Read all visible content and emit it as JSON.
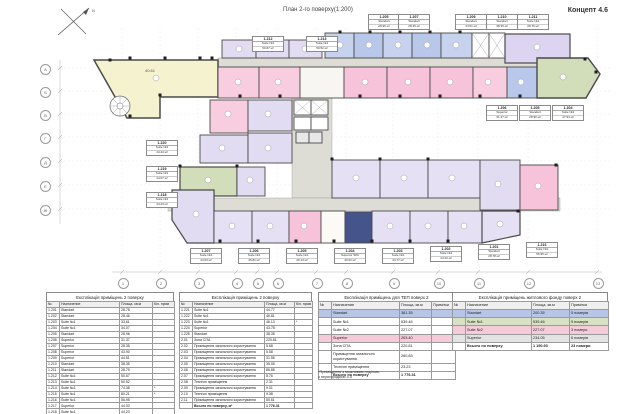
{
  "header": {
    "title": "План 2-го поверху(1:200)",
    "concept": "Концепт 4.6",
    "north_label": "N"
  },
  "plan": {
    "hall_area_label": "40.61",
    "grid_bottom": [
      "1",
      "2",
      "3",
      "4",
      "5",
      "6",
      "7",
      "8",
      "9",
      "10",
      "11",
      "12",
      "13"
    ],
    "grid_left": [
      "А",
      "Б",
      "В",
      "Г",
      "Д",
      "Е",
      "Ж"
    ],
    "callouts": {
      "top": [
        {
          "num": "1.212",
          "type": "Suite №1",
          "area": "50.67 м²"
        },
        {
          "num": "1.213",
          "type": "Suite №1",
          "area": "50.52 м²"
        },
        {
          "num": "1.205",
          "type": "Standart",
          "area": "28.96 м²"
        },
        {
          "num": "1.207",
          "type": "Standart",
          "area": "28.35 м²"
        },
        {
          "num": "1.209",
          "type": "Standart",
          "area": "44.51 м²"
        },
        {
          "num": "1.210",
          "type": "Standart",
          "area": "38.35 м²"
        },
        {
          "num": "1.211",
          "type": "Suite №1",
          "area": "28.79 м²"
        }
      ],
      "right": [
        {
          "num": "1.206",
          "type": "Superior",
          "area": "31.37 м²"
        },
        {
          "num": "1.205",
          "type": "Standart",
          "area": "28.96 м²"
        },
        {
          "num": "1.204",
          "type": "Suite №2",
          "area": "47.94 м²"
        }
      ],
      "left": [
        {
          "num": "1.220",
          "type": "Suite №1",
          "area": "44.44 м²"
        },
        {
          "num": "1.219",
          "type": "Suite №1",
          "area": "44.07 м²"
        },
        {
          "num": "1.218",
          "type": "Suite №1",
          "area": "44.23 м²"
        }
      ],
      "bottom": [
        {
          "num": "1.207",
          "type": "Suite №1",
          "area": "44.03 м²"
        },
        {
          "num": "1.206",
          "type": "Suite №1",
          "area": "46.81 м²"
        },
        {
          "num": "1.205",
          "type": "Suite №1",
          "area": "46.13 м²"
        },
        {
          "num": "1.204",
          "type": "Superior SPA",
          "area": "40.02 м²"
        },
        {
          "num": "1.203",
          "type": "Suite №1",
          "area": "44.77 м²"
        },
        {
          "num": "1.202",
          "type": "Suite №1",
          "area": "44.23 м²"
        },
        {
          "num": "1.201",
          "type": "Standart",
          "area": "28.78 м²"
        },
        {
          "num": "1.216",
          "type": "Suite №1",
          "area": "56.95 м²"
        }
      ]
    }
  },
  "tables": [
    {
      "title": "Експлікація приміщень 2 поверху",
      "columns": [
        "№",
        "Назначение",
        "Площа, кв.м",
        "Кіл. прим"
      ],
      "rows": [
        [
          "1.201",
          "Standart",
          "28.78",
          ""
        ],
        [
          "1.202",
          "Standart",
          "28.46",
          ""
        ],
        [
          "1.203",
          "Suite №1",
          "33.61",
          ""
        ],
        [
          "1.204",
          "Suite №1",
          "34.07",
          ""
        ],
        [
          "1.205",
          "Standart",
          "28.96",
          ""
        ],
        [
          "1.206",
          "Superior",
          "31.37",
          ""
        ],
        [
          "1.207",
          "Superior",
          "28.35",
          ""
        ],
        [
          "1.208",
          "Superior",
          "43.90",
          ""
        ],
        [
          "1.209",
          "Superior",
          "44.51",
          ""
        ],
        [
          "1.210",
          "Standart",
          "38.35",
          ""
        ],
        [
          "1.211",
          "Standart",
          "28.79",
          ""
        ],
        [
          "1.212",
          "Suite №1",
          "50.67",
          ""
        ],
        [
          "1.213",
          "Suite №1",
          "50.52",
          ""
        ],
        [
          "1.214",
          "Suite №1",
          "74.38",
          "*"
        ],
        [
          "1.215",
          "Suite №1",
          "80.21",
          "*"
        ],
        [
          "1.216",
          "Suite №1",
          "56.95",
          ""
        ],
        [
          "1.217",
          "Superior",
          "44.03",
          ""
        ],
        [
          "1.218",
          "Suite №1",
          "44.23",
          ""
        ],
        [
          "1.219",
          "Suite №1",
          "44.07",
          ""
        ],
        [
          "1.220",
          "Suite №1",
          "44.44",
          ""
        ]
      ]
    },
    {
      "title": "Експлікація приміщень 2 поверху",
      "columns": [
        "№",
        "Назначение",
        "Площа, кв.м",
        "Кіл. прим"
      ],
      "rows": [
        [
          "1.221",
          "Suite №1",
          "44.77",
          ""
        ],
        [
          "1.222",
          "Suite №1",
          "46.81",
          ""
        ],
        [
          "1.223",
          "Suite №1",
          "46.13",
          "*"
        ],
        [
          "1.224",
          "Superior",
          "43.78",
          ""
        ],
        [
          "1.225",
          "Standart",
          "38.35",
          ""
        ],
        [
          "2.01",
          "Зона СПА",
          "220.81",
          ""
        ],
        [
          "2.02",
          "Приміщення загального користування",
          "5.68",
          ""
        ],
        [
          "2.03",
          "Приміщення загального користування",
          "5.58",
          ""
        ],
        [
          "2.04",
          "Приміщення загального користування",
          "31.56",
          ""
        ],
        [
          "2.05",
          "Приміщення загального користування",
          "35.05",
          ""
        ],
        [
          "2.06",
          "Приміщення загального користування",
          "86.88",
          ""
        ],
        [
          "2.07",
          "Приміщення загального користування",
          "8.76",
          ""
        ],
        [
          "2.08",
          "Технічні приміщення",
          "2.31",
          ""
        ],
        [
          "2.09",
          "Приміщення загального користування",
          "9.31",
          ""
        ],
        [
          "2.10",
          "Технічні приміщення",
          "9.38",
          ""
        ],
        [
          "2.11",
          "Приміщення загального користування",
          "80.61",
          ""
        ]
      ],
      "footer": [
        "",
        "Всього по поверху, м²",
        "1 776.31",
        ""
      ]
    },
    {
      "title": "Експлікація приміщень для ТЕП поверх 2",
      "columns": [
        "№",
        "Назначение",
        "Площа, кв.м",
        "Примітки"
      ],
      "rows": [
        [
          "",
          "Standart",
          "381.35",
          ""
        ],
        [
          "",
          "Suite №1",
          "539.46",
          ""
        ],
        [
          "",
          "Suite №2",
          "227.07",
          ""
        ],
        [
          "",
          "Superior",
          "263.40",
          ""
        ],
        [
          "",
          "Зона СПА",
          "220.81",
          ""
        ],
        [
          "",
          "Приміщення загального користування",
          "260.83",
          ""
        ],
        [
          "",
          "Технічні приміщення",
          "23.23",
          ""
        ]
      ],
      "row_colors": [
        "#b9c5e6",
        "",
        "",
        "#f5cbd9",
        "",
        "",
        ""
      ],
      "footer": [
        "",
        "Всього по поверху",
        "1 776.31",
        ""
      ],
      "footnote": "*Приміщення з можливим поділом,\nз перегородкою 4.5"
    },
    {
      "title": "Експлікація приміщень житлового фонду поверх 2",
      "columns": [
        "№",
        "Назначение",
        "Площа, кв.м",
        "Примітка"
      ],
      "rows": [
        [
          "",
          "Standart",
          "200.35",
          "5 номерів"
        ],
        [
          "",
          "Suite №1",
          "539.46",
          "9 номерів"
        ],
        [
          "",
          "Suite №2",
          "227.07",
          "3 номери"
        ],
        [
          "",
          "Superior",
          "234.05",
          "6 номерів"
        ]
      ],
      "row_colors": [
        "#b9c5e6",
        "#d6e2c3",
        "#f5cbd9",
        "#e3e3e3"
      ],
      "footer": [
        "",
        "Всього по поверху",
        "1 190.93",
        "23 номери"
      ]
    }
  ]
}
